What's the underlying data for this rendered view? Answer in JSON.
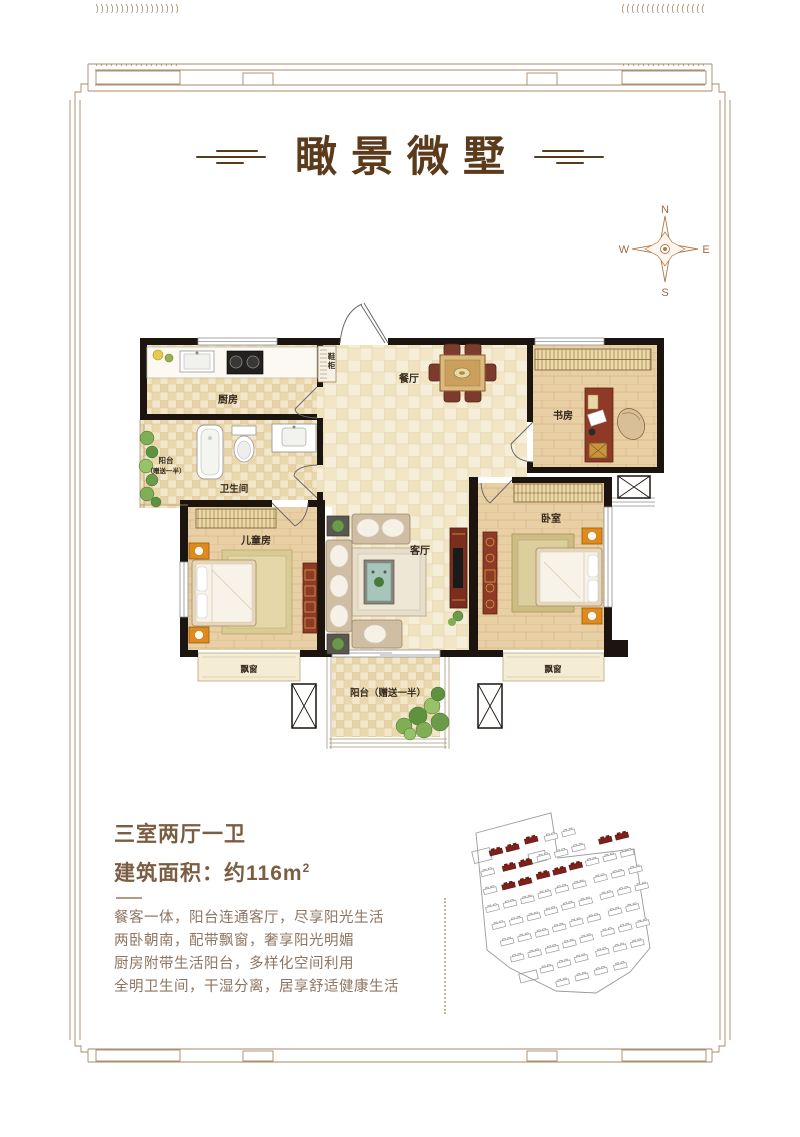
{
  "title": {
    "text": "瞰景微墅"
  },
  "compass": {
    "north": "N",
    "east": "E",
    "south": "S",
    "west": "W"
  },
  "floorplan": {
    "rooms": {
      "kitchen": "厨房",
      "dining": "餐厅",
      "study": "书房",
      "bathroom": "卫生间",
      "balcony_left_line1": "阳台",
      "balcony_left_line2": "（赠送一半）",
      "kids_room": "儿童房",
      "living": "客厅",
      "bedroom": "卧室",
      "bay_window": "飘窗",
      "balcony_bottom": "阳台（赠送一半）",
      "shoe_cabinet_char1": "鞋",
      "shoe_cabinet_char2": "柜"
    }
  },
  "info": {
    "layout": "三室两厅一卫",
    "area_label": "建筑面积：约116m",
    "area_sup": "2",
    "lines": [
      "餐客一体，阳台连通客厅，尽享阳光生活",
      "两卧朝南，配带飘窗，奢享阳光明媚",
      "厨房附带生活阳台，多样化空间利用",
      "全明卫生间，干湿分离，居享舒适健康生活"
    ]
  },
  "colors": {
    "title_brown": "#5c3a1c",
    "heading_brown": "#7b5d42",
    "body_text": "#8d7562",
    "frame_line": "#a78a68",
    "wall_black": "#1b140f",
    "accent_red": "#7e211b",
    "furniture_red": "#8e3a26",
    "nightstand_orange": "#e08a1e",
    "wood_floor": "#e9cfa4",
    "tile_beige": "#f4ebd2",
    "plant_green": "#6a9a4a",
    "compass_brown": "#b07848"
  }
}
